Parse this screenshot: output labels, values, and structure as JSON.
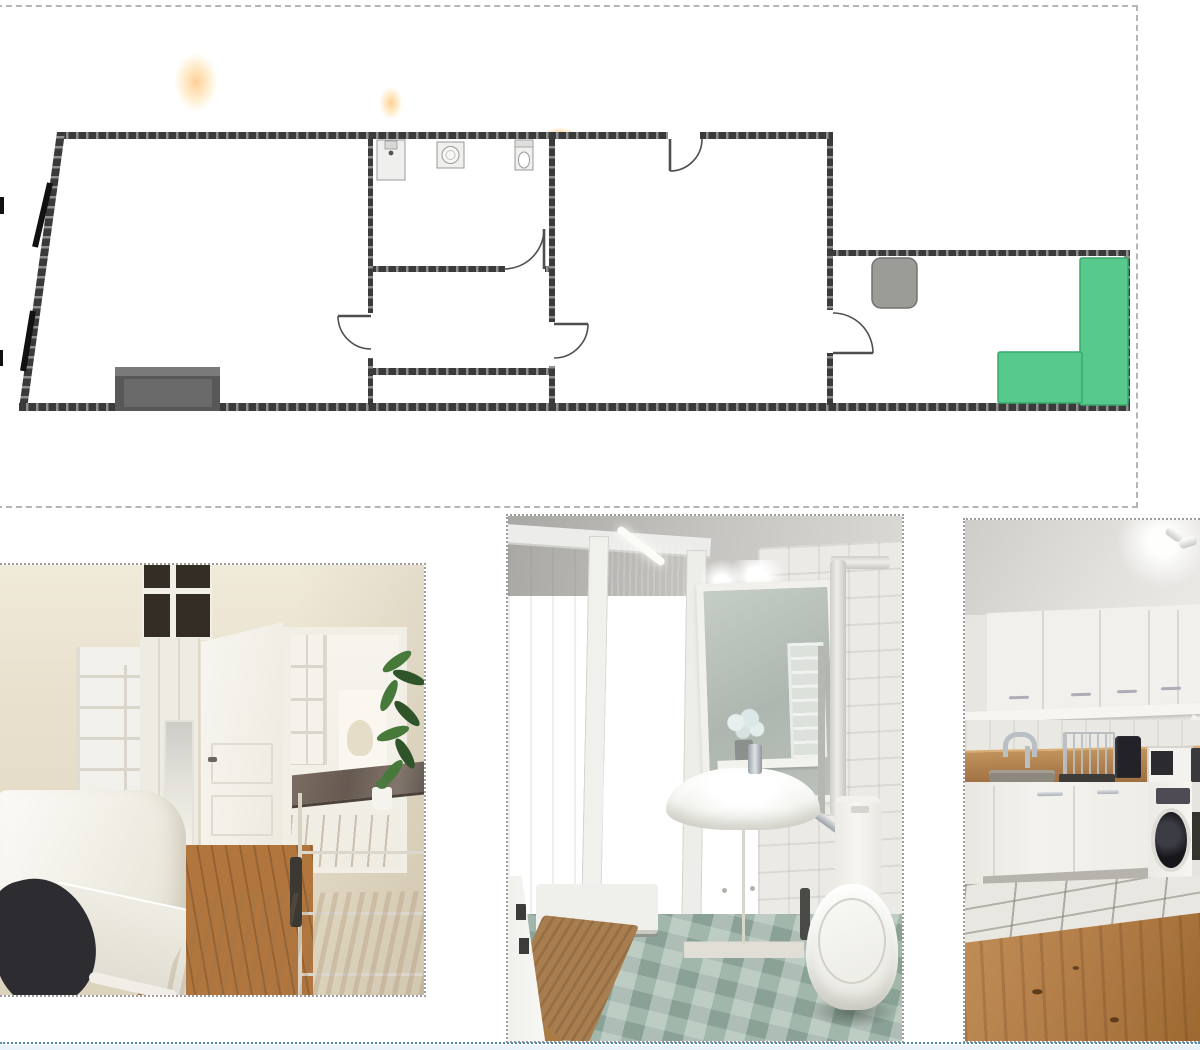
{
  "gallery": {
    "floorplan": {
      "type": "floor-plan-drawing",
      "fixtures": [
        "sink",
        "washing-machine",
        "toilet",
        "bed",
        "kitchen-appliance",
        "kitchen-counter",
        "windows",
        "doors"
      ],
      "rooms_depicted": 5,
      "highlight_shape": "L-shaped green counter"
    },
    "photos": [
      {
        "id": "bedroom-photo",
        "subject": "bedroom with white bed, shelving, open door and wooden desk"
      },
      {
        "id": "bathroom-photo",
        "subject": "bathroom with shower, vanity sink, mirror and toilet"
      },
      {
        "id": "kitchen-photo",
        "subject": "kitchen with white cabinets, wooden counter and washing machine"
      }
    ]
  },
  "colors": {
    "planBorder": "#b5b5b5",
    "planWall": "#3a3a3a",
    "planTick": "#8f8f8f",
    "planLine": "#4f4f4f",
    "fixtureFill": "#efefed",
    "fixtureStroke": "#9a9a98",
    "bed": "#585858",
    "bedInner": "#6a6a6a",
    "appliance": "#9b9b98",
    "green": "#56c98c",
    "greenDark": "#3aa96d",
    "orange": "#ffa53c",
    "black": "#111111",
    "photoBorder": "#9c9c9c",
    "rule": "#4f90a8",
    "strip": "#e9f3f9",
    "pane": "#332d26",
    "woodFloor": "#b0763e",
    "desk": "#d7c3a8",
    "marble": "#655950",
    "plant": "#47793b",
    "chair": "#2d2d31",
    "glass": "#aab0a8",
    "sage": "#a2b7ab",
    "mat": "#a87e50",
    "cab": "#f1f0ec",
    "counterWood": "#a97a4a",
    "steel": "#b9bfc4",
    "washerDoor": "#17171b",
    "oak": "#b07a45"
  }
}
